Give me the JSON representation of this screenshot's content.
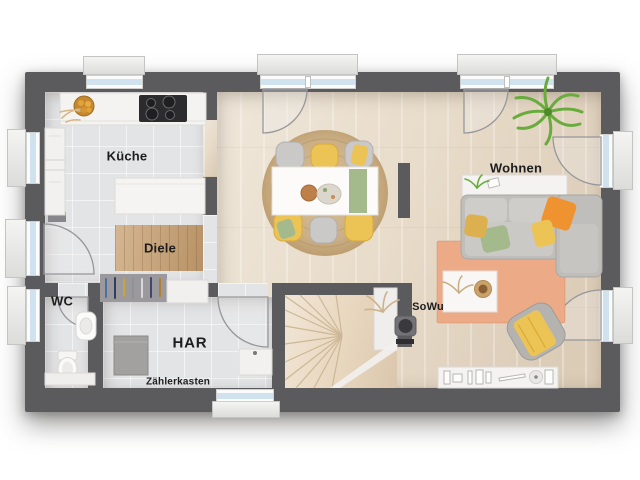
{
  "plan": {
    "type": "floor-plan-top-view",
    "rooms": {
      "kueche": {
        "label": "Küche"
      },
      "diele": {
        "label": "Diele"
      },
      "wc": {
        "label": "WC"
      },
      "har": {
        "label": "HAR"
      },
      "zaehlerkasten": {
        "label": "Zählerkasten"
      },
      "sowu": {
        "label": "SoWu"
      },
      "wohnen": {
        "label": "Wohnen"
      }
    },
    "colors": {
      "wall": "#5b5b5e",
      "tile": "#e3e4e6",
      "wood": "#e8dcca",
      "stair-wood": "#e9d8c0",
      "mat-wood": "#c79e6e",
      "rug-jute": "#ccb087",
      "rug-salmon": "#ecaa87",
      "sofa-gray": "#c0beba",
      "accent-yellow": "#ecc355",
      "accent-orange": "#ef9330",
      "accent-green": "#a4ba8d",
      "plant-green": "#69ab3d",
      "glass-blue": "#cfe2ee",
      "counter-white": "#f4f3f1"
    }
  }
}
